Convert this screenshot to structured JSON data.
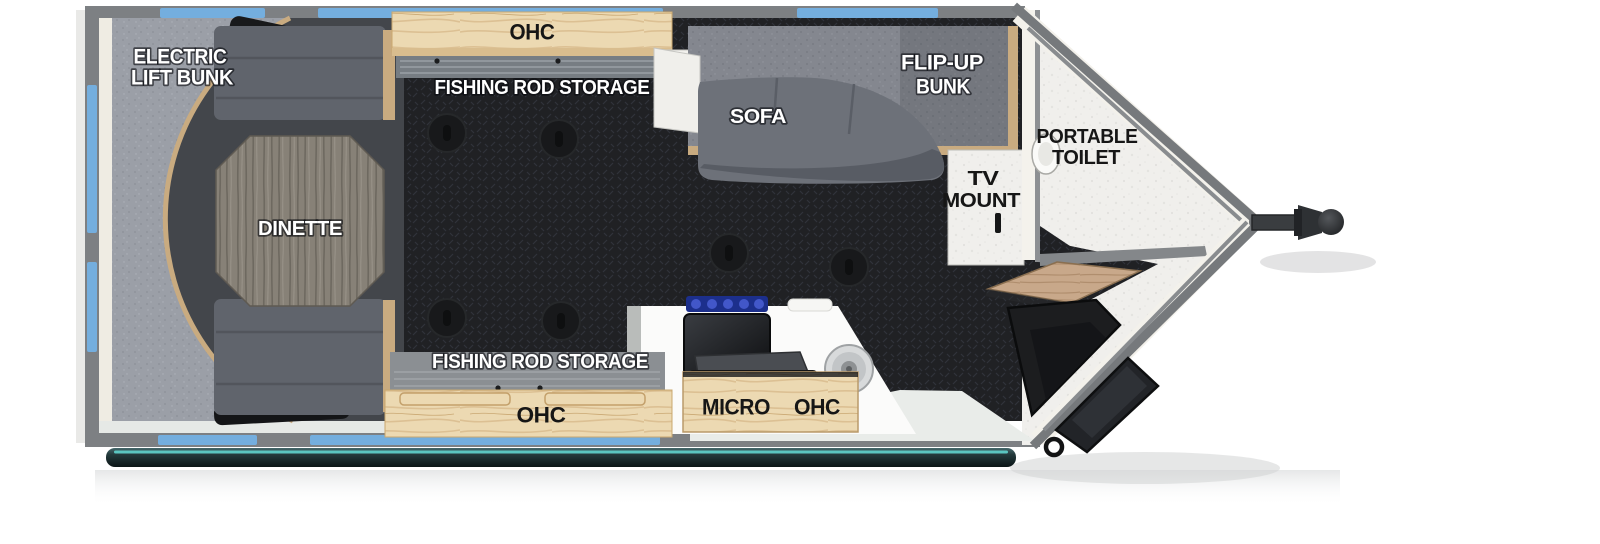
{
  "diagram": {
    "type": "rv-travel-trailer-floorplan",
    "labels": {
      "electric_lift_bunk": {
        "line1": "ELECTRIC",
        "line2": "LIFT BUNK"
      },
      "ohc_top": "OHC",
      "fishing_rod_storage_top": "FISHING ROD STORAGE",
      "sofa": "SOFA",
      "flip_up_bunk": {
        "line1": "FLIP-UP",
        "line2": "BUNK"
      },
      "portable_toilet": {
        "line1": "PORTABLE",
        "line2": "TOILET"
      },
      "tv_mount": {
        "line1": "TV",
        "line2": "MOUNT"
      },
      "dinette": "DINETTE",
      "fishing_rod_storage_bottom": "FISHING ROD STORAGE",
      "ohc_bottom": "OHC",
      "micro": "MICRO",
      "micro_ohc": "OHC"
    },
    "colors": {
      "wall": "#7d8083",
      "window": "#74aede",
      "floor_base": "#202124",
      "lift_bunk_gray": "#9b9fa7",
      "flip_bunk_gray": "#84878f",
      "sofa_gray": "#6d7179",
      "bench_gray": "#60646c",
      "wood_light": "#ecd9b2",
      "wood_trim": "#c9ab80",
      "table_wood": "#878177",
      "counter_white": "#fbfbfa",
      "cooktop_black": "#141619",
      "burner_blue": "#1c2f8c",
      "awning_teal": "#2a4345",
      "awning_highlight": "#5fd3cd",
      "v_floor_white": "#f0efec",
      "step_dark": "#1c1d1f",
      "label_white": "#ffffff",
      "label_black": "#161616"
    }
  }
}
